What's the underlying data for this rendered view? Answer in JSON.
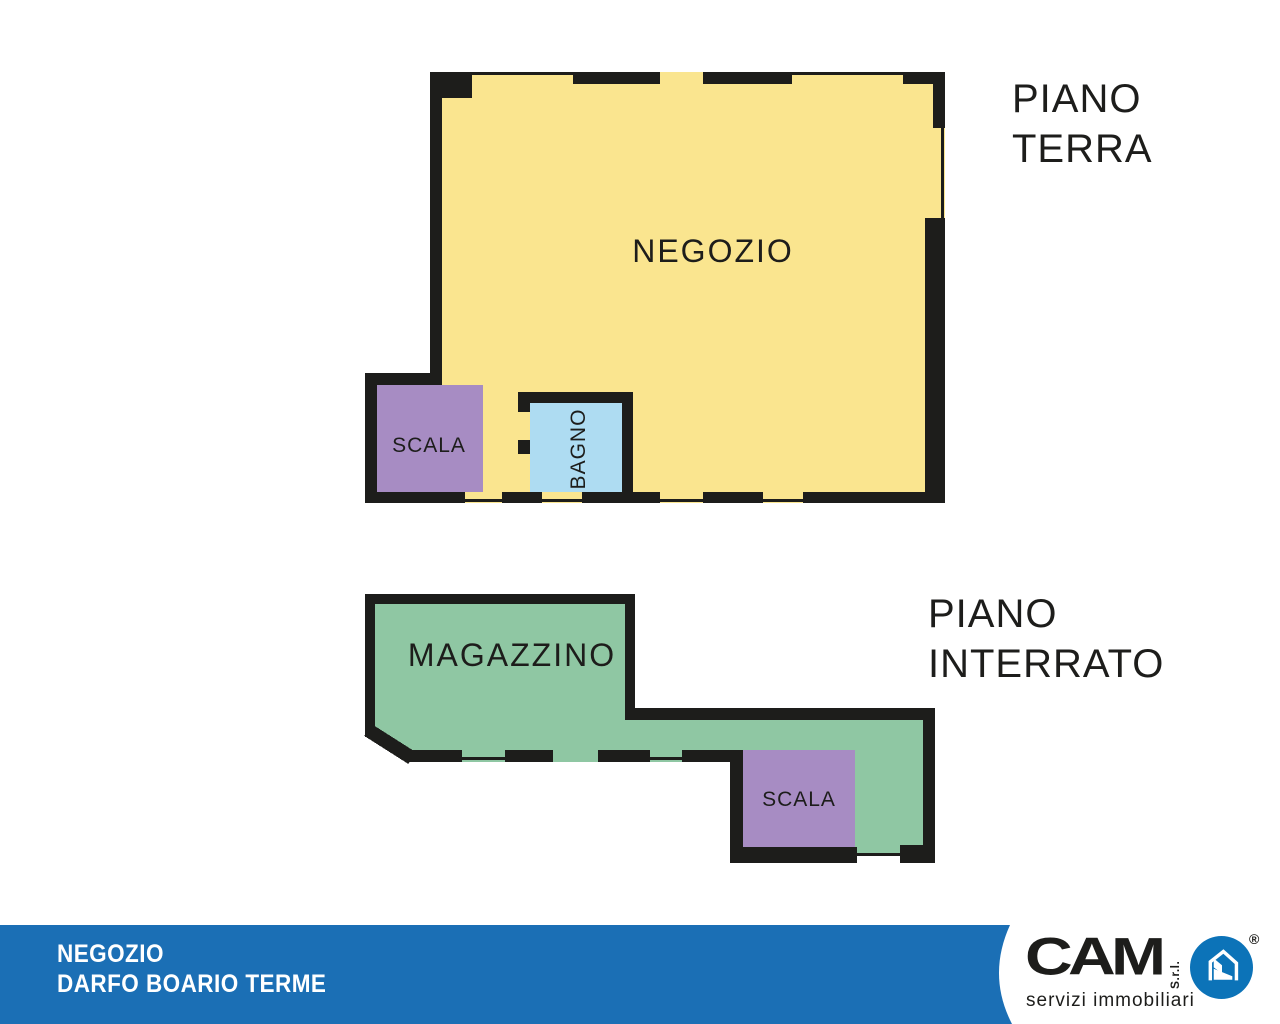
{
  "flyer": {
    "background": "#FFFFFF",
    "wall_color": "#1D1D1B"
  },
  "floors": [
    {
      "name": "piano-terra",
      "title_line1": "PIANO",
      "title_line2": "TERRA",
      "rooms": {
        "negozio": {
          "label": "NEGOZIO",
          "color": "#FAE58F"
        },
        "scala": {
          "label": "SCALA",
          "color": "#A78CC3"
        },
        "bagno": {
          "label": "BAGNO",
          "color": "#AEDCF2"
        }
      }
    },
    {
      "name": "piano-interrato",
      "title_line1": "PIANO",
      "title_line2": "INTERRATO",
      "rooms": {
        "magazzino": {
          "label": "MAGAZZINO",
          "color": "#8FC7A3"
        },
        "scala": {
          "label": "SCALA",
          "color": "#A78CC3"
        }
      }
    }
  ],
  "footer": {
    "property_line1": "NEGOZIO",
    "property_line2": "DARFO BOARIO TERME",
    "bar_color": "#1B6FB5",
    "logo": {
      "brand": "CAM",
      "legal_suffix": "S.r.l.",
      "registered_symbol": "®",
      "tagline": "servizi immobiliari",
      "circle_color": "#0C73B8"
    }
  }
}
